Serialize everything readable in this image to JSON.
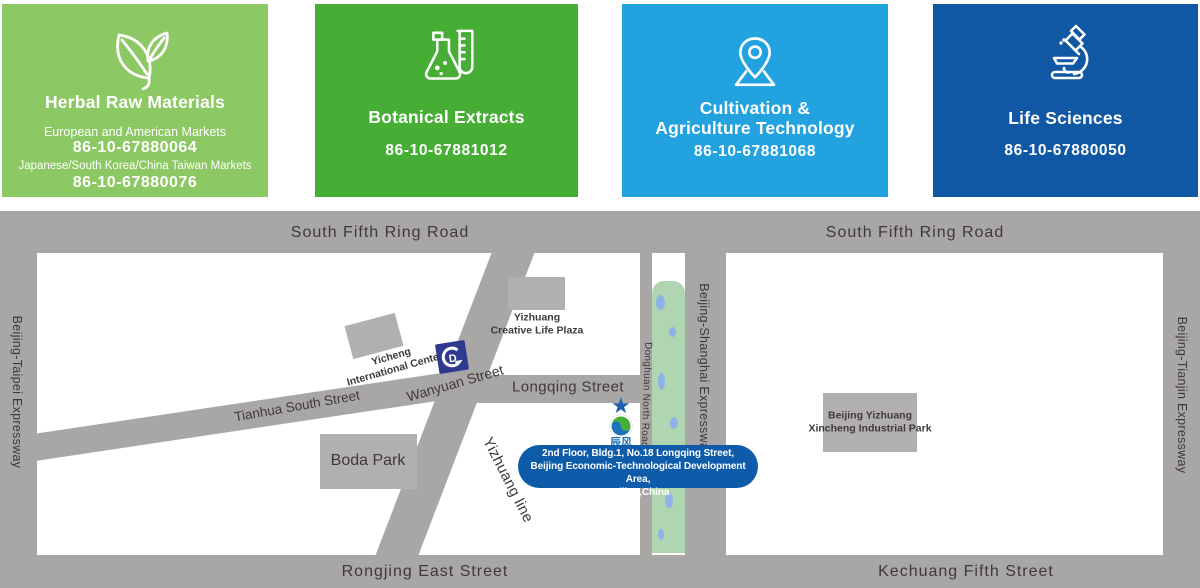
{
  "colors": {
    "card_green_light": "#8CC863",
    "card_green": "#47AE35",
    "card_blue_light": "#22A2DF",
    "card_blue_dark": "#1158A4",
    "map_gray": "#A9A6A6",
    "building_gray": "#B2AFAF",
    "map_text": "#3E3A39",
    "callout_blue": "#0D5BA9",
    "canal_green": "#AFD6B1",
    "water_blue": "#8CB2E8",
    "metro_navy": "#2F3A8E",
    "logo_green": "#45B035",
    "logo_blue": "#1B75BB",
    "star_blue": "#1A5FB0"
  },
  "cards": [
    {
      "title": "Herbal Raw Materials",
      "icon": "leaf",
      "market1_label": "European and American Markets",
      "market1_phone": "86-10-67880064",
      "market2_label": "Japanese/South Korea/China Taiwan Markets",
      "market2_phone": "86-10-67880076"
    },
    {
      "title": "Botanical Extracts",
      "icon": "flask",
      "phone": "86-10-67881012"
    },
    {
      "title_line1": "Cultivation &",
      "title_line2": "Agriculture Technology",
      "icon": "map-pin",
      "phone": "86-10-67881068"
    },
    {
      "title": "Life Sciences",
      "icon": "microscope",
      "phone": "86-10-67880050"
    }
  ],
  "map": {
    "ring_road_left": "South Fifth Ring Road",
    "ring_road_right": "South Fifth Ring Road",
    "bottom_left_street": "Rongjing East Street",
    "bottom_right_street": "Kechuang Fifth Street",
    "expressway_left": "Beijing-Taipei Expressway",
    "expressway_middle": "Beijing-Shanghai Expressway",
    "expressway_right": "Beijing-Tianjin Expressway",
    "donghuan_road": "Donghuan North Road",
    "longqing_street": "Longqing Street",
    "wanyuan_street": "Wanyuan Street",
    "tianhua_street": "Tianhua South Street",
    "yizhuang_line": "Yizhuang line",
    "buildings": {
      "yicheng_line1": "Yicheng",
      "yicheng_line2": "International Center",
      "plaza_line1": "Yizhuang",
      "plaza_line2": "Creative Life Plaza",
      "boda": "Boda Park",
      "industrial_line1": "Beijing Yizhuang",
      "industrial_line2": "Xincheng Industrial Park"
    },
    "metro_glyph": "D",
    "company_logo_text": "辰风",
    "callout": {
      "line1": "2nd Floor, Bldg.1, No.18 Longqing Street,",
      "line2": "Beijing Economic-Technological Development Area,",
      "line3": "Beijing,China"
    }
  }
}
